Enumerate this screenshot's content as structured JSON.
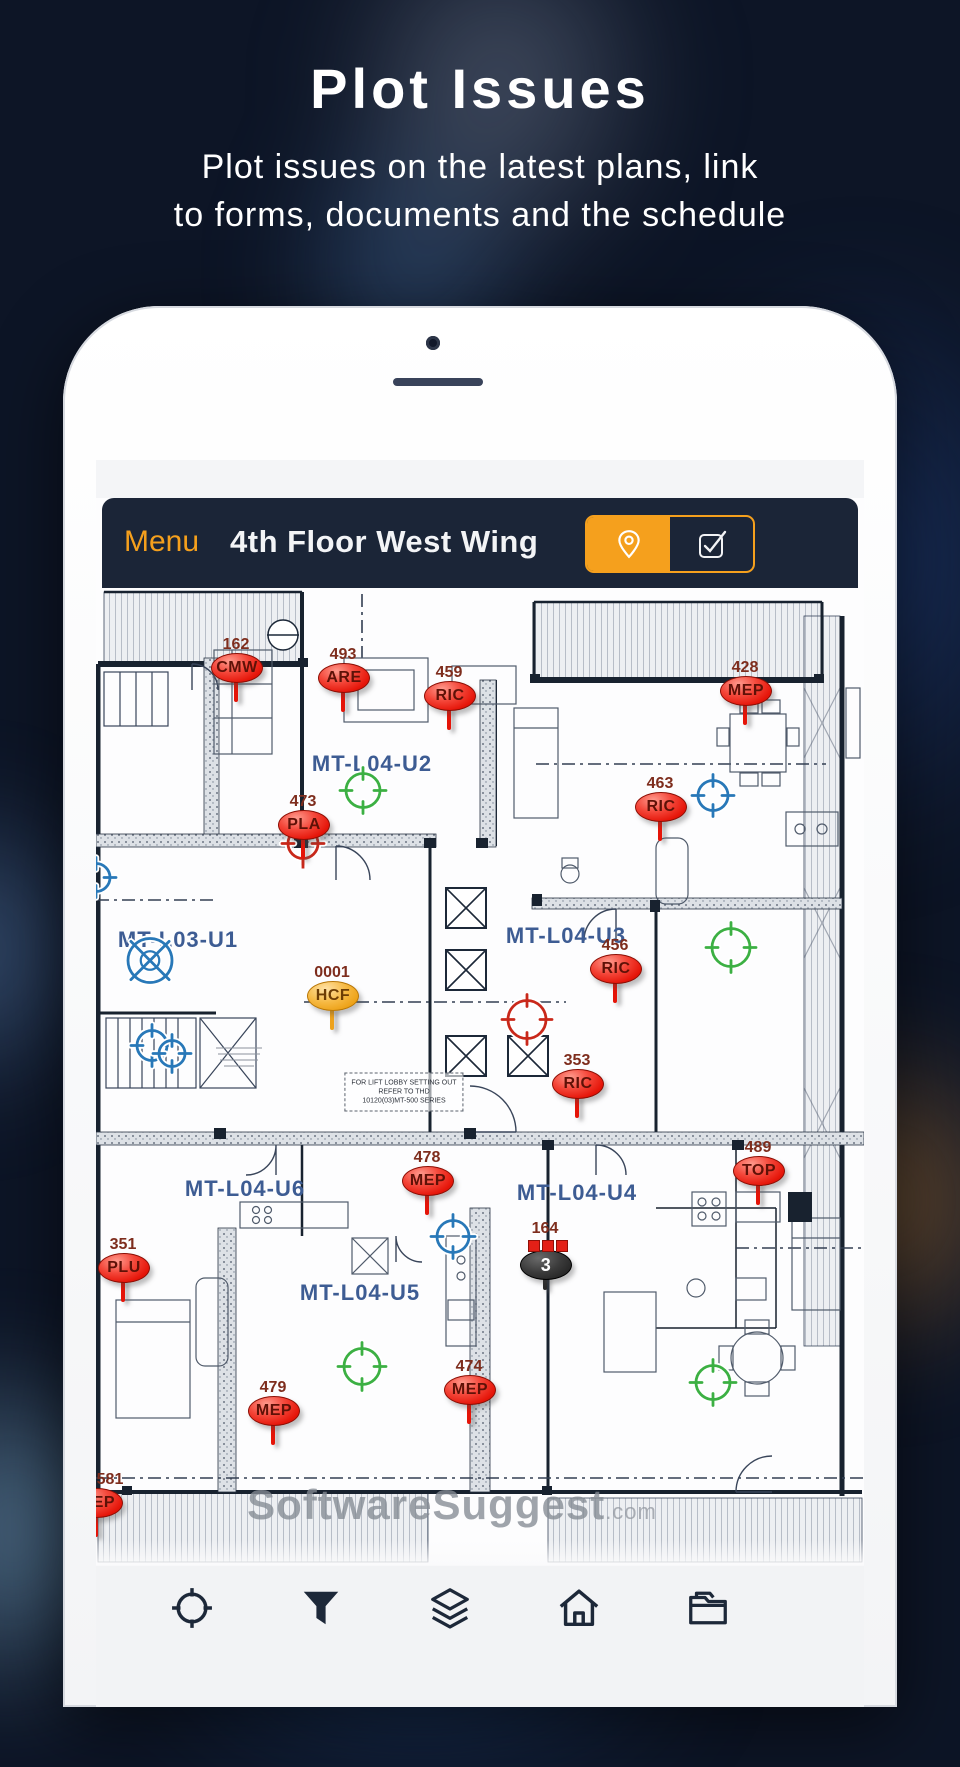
{
  "hero": {
    "title": "Plot Issues",
    "subtitle_line1": "Plot issues on the latest plans, link",
    "subtitle_line2": "to forms, documents and the schedule"
  },
  "header": {
    "menu_label": "Menu",
    "title": "4th Floor West Wing",
    "toggle": {
      "left_icon": "location-pin-icon",
      "right_icon": "checkbox-icon",
      "active": "left"
    }
  },
  "plan": {
    "room_labels": [
      {
        "text": "MT-L04-U2",
        "x": 276,
        "y": 304
      },
      {
        "text": "MT-L03-U1",
        "x": 82,
        "y": 480
      },
      {
        "text": "MT-L04-U3",
        "x": 470,
        "y": 476
      },
      {
        "text": "MT-L04-U6",
        "x": 149,
        "y": 729
      },
      {
        "text": "MT-L04-U4",
        "x": 481,
        "y": 733
      },
      {
        "text": "MT-L04-U5",
        "x": 264,
        "y": 833
      }
    ],
    "markers": [
      {
        "number": "162",
        "code": "CMW",
        "x": 140,
        "y": 207,
        "variant": "red"
      },
      {
        "number": "493",
        "code": "ARE",
        "x": 247,
        "y": 217,
        "variant": "red"
      },
      {
        "number": "459",
        "code": "RIC",
        "x": 353,
        "y": 235,
        "variant": "red"
      },
      {
        "number": "428",
        "code": "MEP",
        "x": 649,
        "y": 230,
        "variant": "red"
      },
      {
        "number": "463",
        "code": "RIC",
        "x": 564,
        "y": 346,
        "variant": "red"
      },
      {
        "number": "473",
        "code": "PLA",
        "x": 207,
        "y": 364,
        "variant": "red"
      },
      {
        "number": "456",
        "code": "RIC",
        "x": 519,
        "y": 508,
        "variant": "red"
      },
      {
        "number": "0001",
        "code": "HCF",
        "x": 236,
        "y": 535,
        "variant": "orange"
      },
      {
        "number": "353",
        "code": "RIC",
        "x": 481,
        "y": 623,
        "variant": "red"
      },
      {
        "number": "478",
        "code": "MEP",
        "x": 331,
        "y": 720,
        "variant": "red"
      },
      {
        "number": "489",
        "code": "TOP",
        "x": 662,
        "y": 710,
        "variant": "red"
      },
      {
        "number": "351",
        "code": "PLU",
        "x": 27,
        "y": 807,
        "variant": "red"
      },
      {
        "number": "474",
        "code": "MEP",
        "x": 373,
        "y": 929,
        "variant": "red"
      },
      {
        "number": "479",
        "code": "MEP",
        "x": 177,
        "y": 950,
        "variant": "red"
      },
      {
        "number": "581",
        "code": "MEP",
        "x": 0,
        "y": 1042,
        "variant": "red",
        "num_dx": 14
      }
    ],
    "group_marker": {
      "number": "164",
      "count": "3",
      "x": 449,
      "y": 804
    },
    "crosshairs": [
      {
        "color": "#3CB043",
        "x": 267,
        "y": 333,
        "r": 17,
        "style": "ticks"
      },
      {
        "color": "#3CB043",
        "x": 635,
        "y": 490,
        "r": 19,
        "style": "ticks"
      },
      {
        "color": "#3CB043",
        "x": 266,
        "y": 909,
        "r": 18,
        "style": "ticks"
      },
      {
        "color": "#3CB043",
        "x": 617,
        "y": 925,
        "r": 17,
        "style": "ticks"
      },
      {
        "color": "#C9281A",
        "x": 207,
        "y": 386,
        "r": 15,
        "style": "ticks",
        "stem": true
      },
      {
        "color": "#C9281A",
        "x": 431,
        "y": 562,
        "r": 19,
        "style": "ticks"
      },
      {
        "color": "#2878B8",
        "x": 617,
        "y": 338,
        "r": 15,
        "style": "ticks"
      },
      {
        "color": "#2878B8",
        "x": 54,
        "y": 503,
        "r": 22,
        "style": "x"
      },
      {
        "color": "#2878B8",
        "x": 56,
        "y": 588,
        "r": 15,
        "style": "ticks"
      },
      {
        "color": "#2878B8",
        "x": 76,
        "y": 596,
        "r": 13,
        "style": "ticks"
      },
      {
        "color": "#2878B8",
        "x": 357,
        "y": 779,
        "r": 16,
        "style": "ticks"
      },
      {
        "color": "#2878B8",
        "x": 0,
        "y": 420,
        "r": 14,
        "style": "ticks"
      }
    ],
    "lift_note": {
      "lines": [
        "FOR LIFT LOBBY SETTING OUT",
        "REFER TO THD",
        "10120(03)MT-500 SERIES"
      ],
      "x": 308,
      "y": 632
    },
    "watermark": {
      "main": "SoftwareSuggest",
      "suffix": ".com",
      "x": 356,
      "y": 1045
    }
  },
  "toolbar": {
    "icons": [
      "locate-target",
      "filter-funnel",
      "layers",
      "home",
      "documents-folder"
    ]
  },
  "colors": {
    "accent_orange": "#F5A01D",
    "header_navy": "#1B2537",
    "marker_red": "#E8231A",
    "marker_orange": "#F5B544",
    "room_label_blue": "#3D5C93",
    "crosshair_green": "#3CB043",
    "crosshair_blue": "#2878B8",
    "crosshair_red": "#C9281A"
  }
}
